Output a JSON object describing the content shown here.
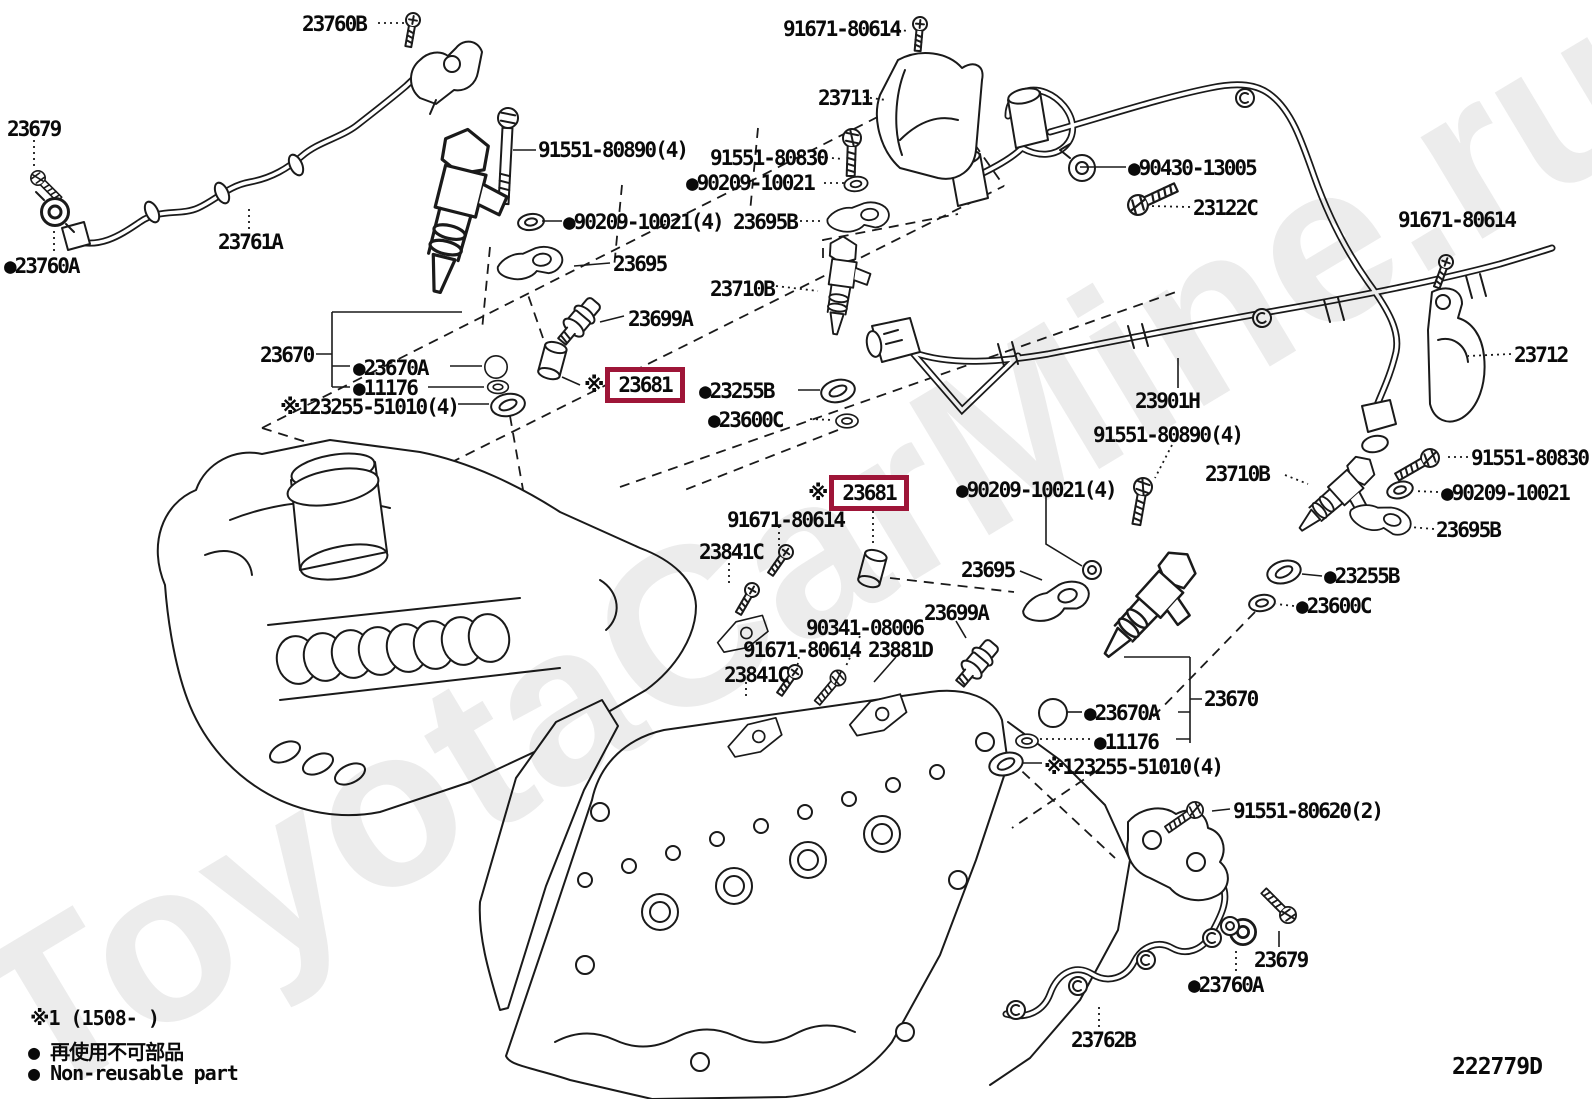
{
  "watermark": "ToyotaCarMine.ru",
  "diagram_code": "222779D",
  "highlight_color": "#9e1538",
  "legend": {
    "note1": "※1 (1508-      )",
    "nonreusable_jp": "● 再使用不可部品",
    "nonreusable_en": "● Non-reusable part"
  },
  "labels": [
    {
      "text": "23760B"
    },
    {
      "text": "91671-80614"
    },
    {
      "text": "23679"
    },
    {
      "text": "23711"
    },
    {
      "text": "91551-80890(4)"
    },
    {
      "text": "91551-80830"
    },
    {
      "text": "●90209-10021"
    },
    {
      "text": "●90430-13005"
    },
    {
      "text": "23122C"
    },
    {
      "text": "●23760A"
    },
    {
      "text": "23761A"
    },
    {
      "text": "●90209-10021(4)"
    },
    {
      "text": "23695B"
    },
    {
      "text": "91671-80614"
    },
    {
      "text": "23695"
    },
    {
      "text": "23710B"
    },
    {
      "text": "23699A"
    },
    {
      "text": "23712"
    },
    {
      "text": "23670"
    },
    {
      "text": "●23670A"
    },
    {
      "text": "●11176"
    },
    {
      "text": "※123255-51010(4)"
    },
    {
      "prefix": "※",
      "text": "23681"
    },
    {
      "text": "●23255B"
    },
    {
      "text": "●23600C"
    },
    {
      "text": "23901H"
    },
    {
      "text": "91551-80890(4)"
    },
    {
      "text": "23710B"
    },
    {
      "text": "91551-80830"
    },
    {
      "text": "●90209-10021"
    },
    {
      "text": "23695B"
    },
    {
      "prefix": "※",
      "text": "23681"
    },
    {
      "text": "●90209-10021(4)"
    },
    {
      "text": "91671-80614"
    },
    {
      "text": "23841C"
    },
    {
      "text": "23695"
    },
    {
      "text": "●23255B"
    },
    {
      "text": "●23600C"
    },
    {
      "text": "23699A"
    },
    {
      "text": "90341-08006"
    },
    {
      "text": "91671-80614"
    },
    {
      "text": "23881D"
    },
    {
      "text": "23841C"
    },
    {
      "text": "23670"
    },
    {
      "text": "●23670A"
    },
    {
      "text": "●11176"
    },
    {
      "text": "※123255-51010(4)"
    },
    {
      "text": "91551-80620(2)"
    },
    {
      "text": "23679"
    },
    {
      "text": "●23760A"
    },
    {
      "text": "23762B"
    }
  ]
}
